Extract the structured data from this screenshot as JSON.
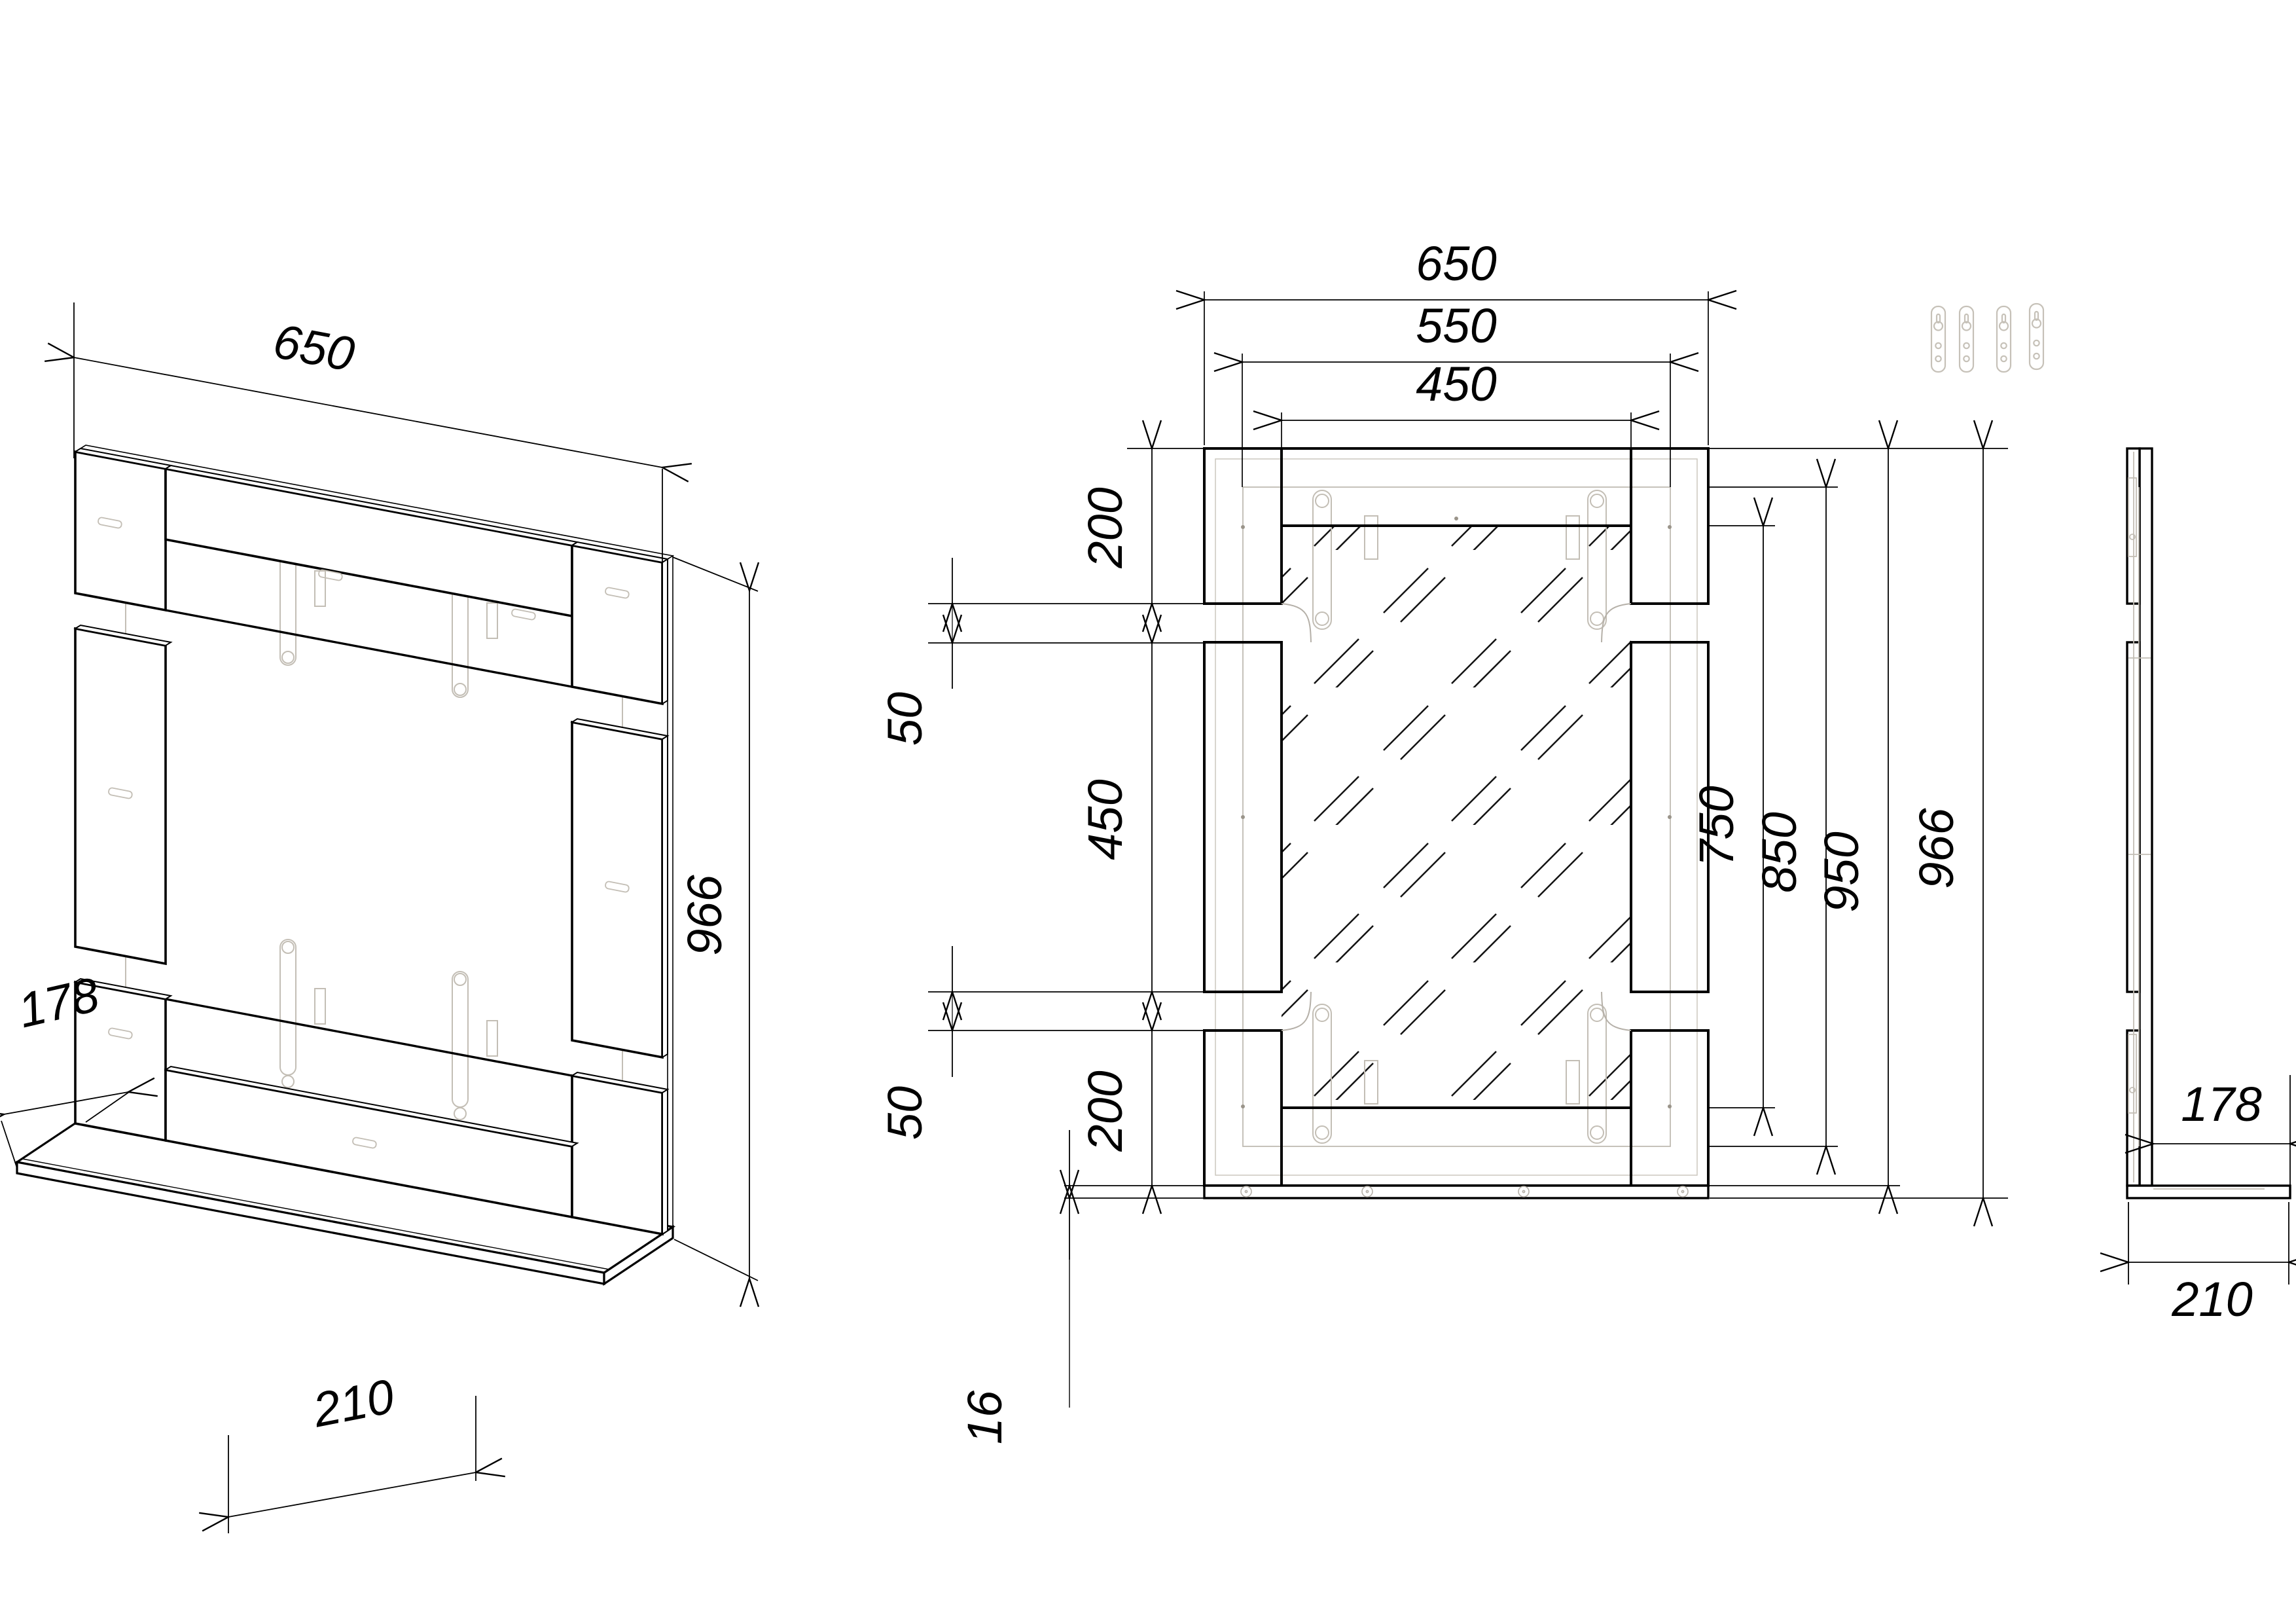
{
  "sheet": {
    "title": "mirror-with-shelf assembly drawing",
    "background": "#ffffff",
    "line_color": "#000000",
    "hidden_line_color": "#c3beb5"
  },
  "views": {
    "isometric": {
      "label": "isometric-view",
      "width_mm": "650",
      "total_height_mm": "966",
      "shelf_depth_mm": "178",
      "total_depth_mm": "210"
    },
    "front": {
      "label": "front-view",
      "width_mm": "650",
      "glass_width_mm": "550",
      "opening_width_mm": "450",
      "corner_block_mm": "200",
      "gap_mm": "50",
      "side_strip_mm": "450",
      "shelf_thickness_mm": "16",
      "opening_height_mm": "750",
      "glass_height_mm": "850",
      "frame_height_mm": "950",
      "total_height_mm": "966"
    },
    "side": {
      "label": "side-view",
      "shelf_depth_mm": "178",
      "total_depth_mm": "210"
    }
  },
  "hardware": {
    "item": "keyhole hanger plate",
    "count": 4
  }
}
